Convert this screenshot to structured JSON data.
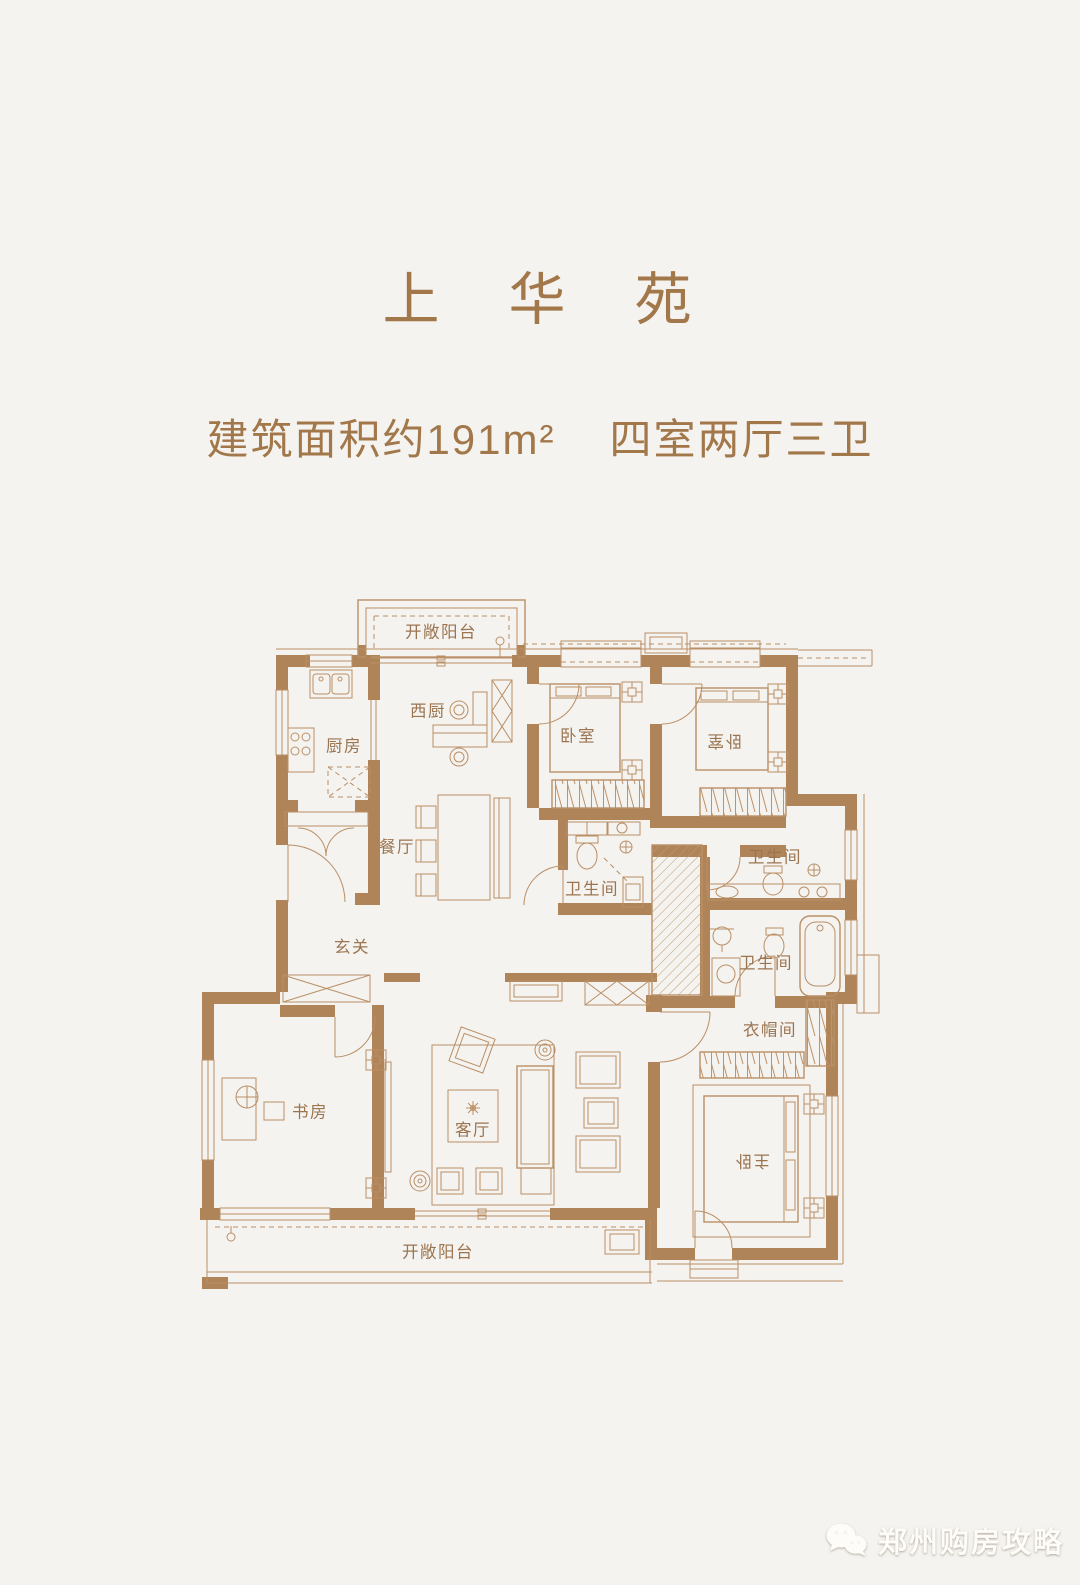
{
  "page": {
    "background": "#f4f3ef"
  },
  "header": {
    "title": "上　华　苑",
    "area": "建筑面积约191m²",
    "layout": "四室两厅三卫"
  },
  "floorplan": {
    "colors": {
      "wall": "#b08459",
      "line": "#ba8f66",
      "label": "#9b7450"
    },
    "rooms": {
      "balcony_top": "开敞阳台",
      "kitchen": "厨房",
      "west_kitchen": "西厨",
      "dining": "餐厅",
      "bedroom_left": "卧室",
      "bedroom_right": "卧室",
      "bath_middle": "卫生间",
      "bath_right_upper": "卫生间",
      "bath_right_lower": "卫生间",
      "entry": "玄关",
      "study": "书房",
      "living": "客厅",
      "cloakroom": "衣帽间",
      "master_bedroom": "主卧",
      "balcony_bottom": "开敞阳台"
    }
  },
  "watermark": {
    "text": "郑州购房攻略",
    "icon": "wechat-icon"
  }
}
